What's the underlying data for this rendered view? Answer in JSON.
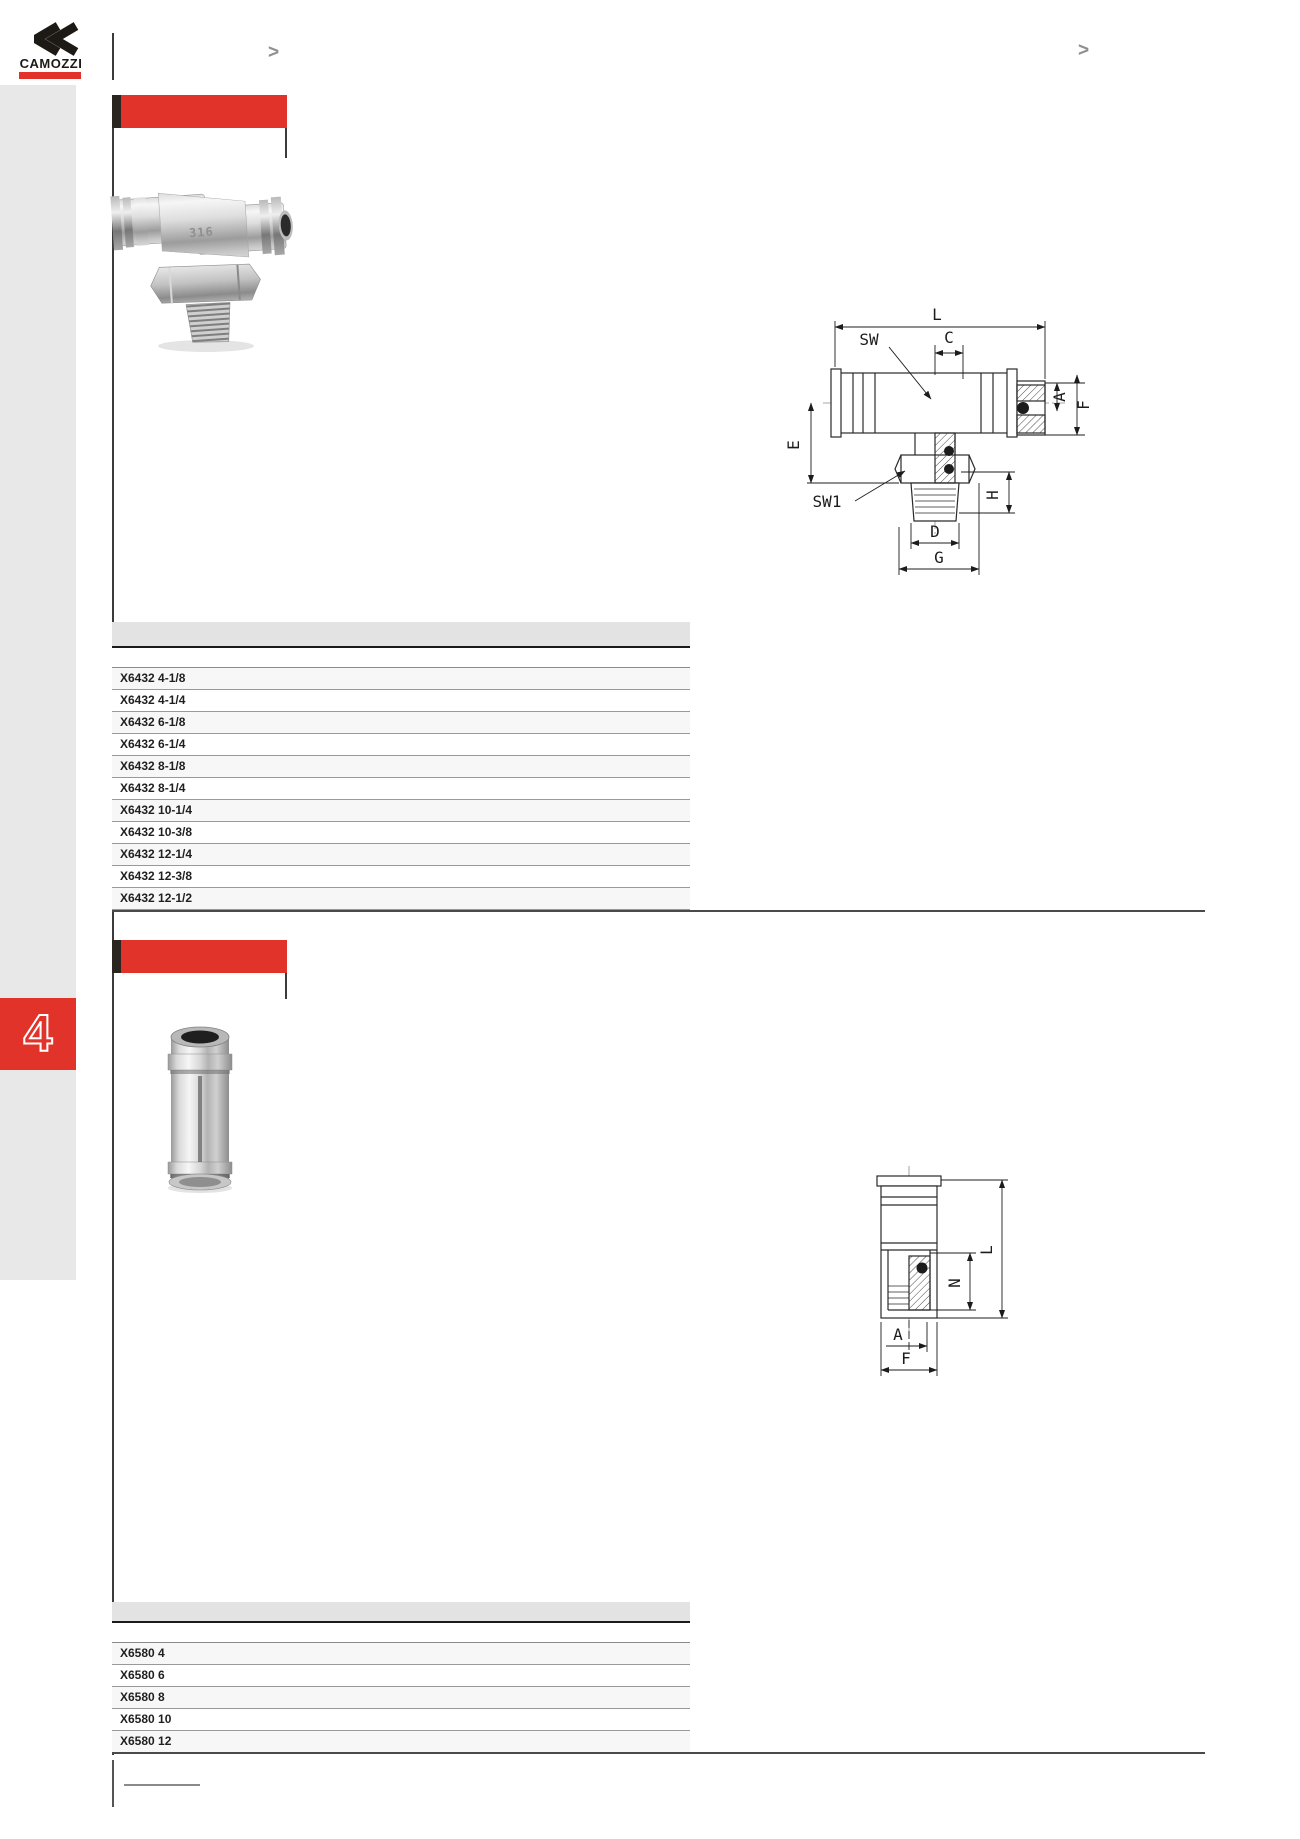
{
  "brand": {
    "name": "CAMOZZI"
  },
  "header": {
    "nav_marker_left": ">",
    "nav_marker_right": ">"
  },
  "sidebar": {
    "chapter_number": "4"
  },
  "sections": [
    {
      "photo_stamp": "316",
      "drawing_labels": {
        "L": "L",
        "SW": "SW",
        "C": "C",
        "A": "A",
        "F": "F",
        "E": "E",
        "SW1": "SW1",
        "H": "H",
        "D": "D",
        "G": "G"
      },
      "table_rows": [
        "X6432 4-1/8",
        "X6432 4-1/4",
        "X6432 6-1/8",
        "X6432 6-1/4",
        "X6432 8-1/8",
        "X6432 8-1/4",
        "X6432 10-1/4",
        "X6432 10-3/8",
        "X6432 12-1/4",
        "X6432 12-3/8",
        "X6432 12-1/2"
      ]
    },
    {
      "drawing_labels": {
        "L": "L",
        "N": "N",
        "A": "A",
        "F": "F"
      },
      "table_rows": [
        "X6580 4",
        "X6580 6",
        "X6580 8",
        "X6580 10",
        "X6580 12"
      ]
    }
  ],
  "colors": {
    "accent_red": "#e2332a",
    "title_tick_black": "#2b2520",
    "sidebar_gray": "#e8e8e8",
    "table_header_gray": "#e3e3e3",
    "row_alt_gray": "#f7f7f7",
    "rule_dark": "#3b3b3b"
  }
}
